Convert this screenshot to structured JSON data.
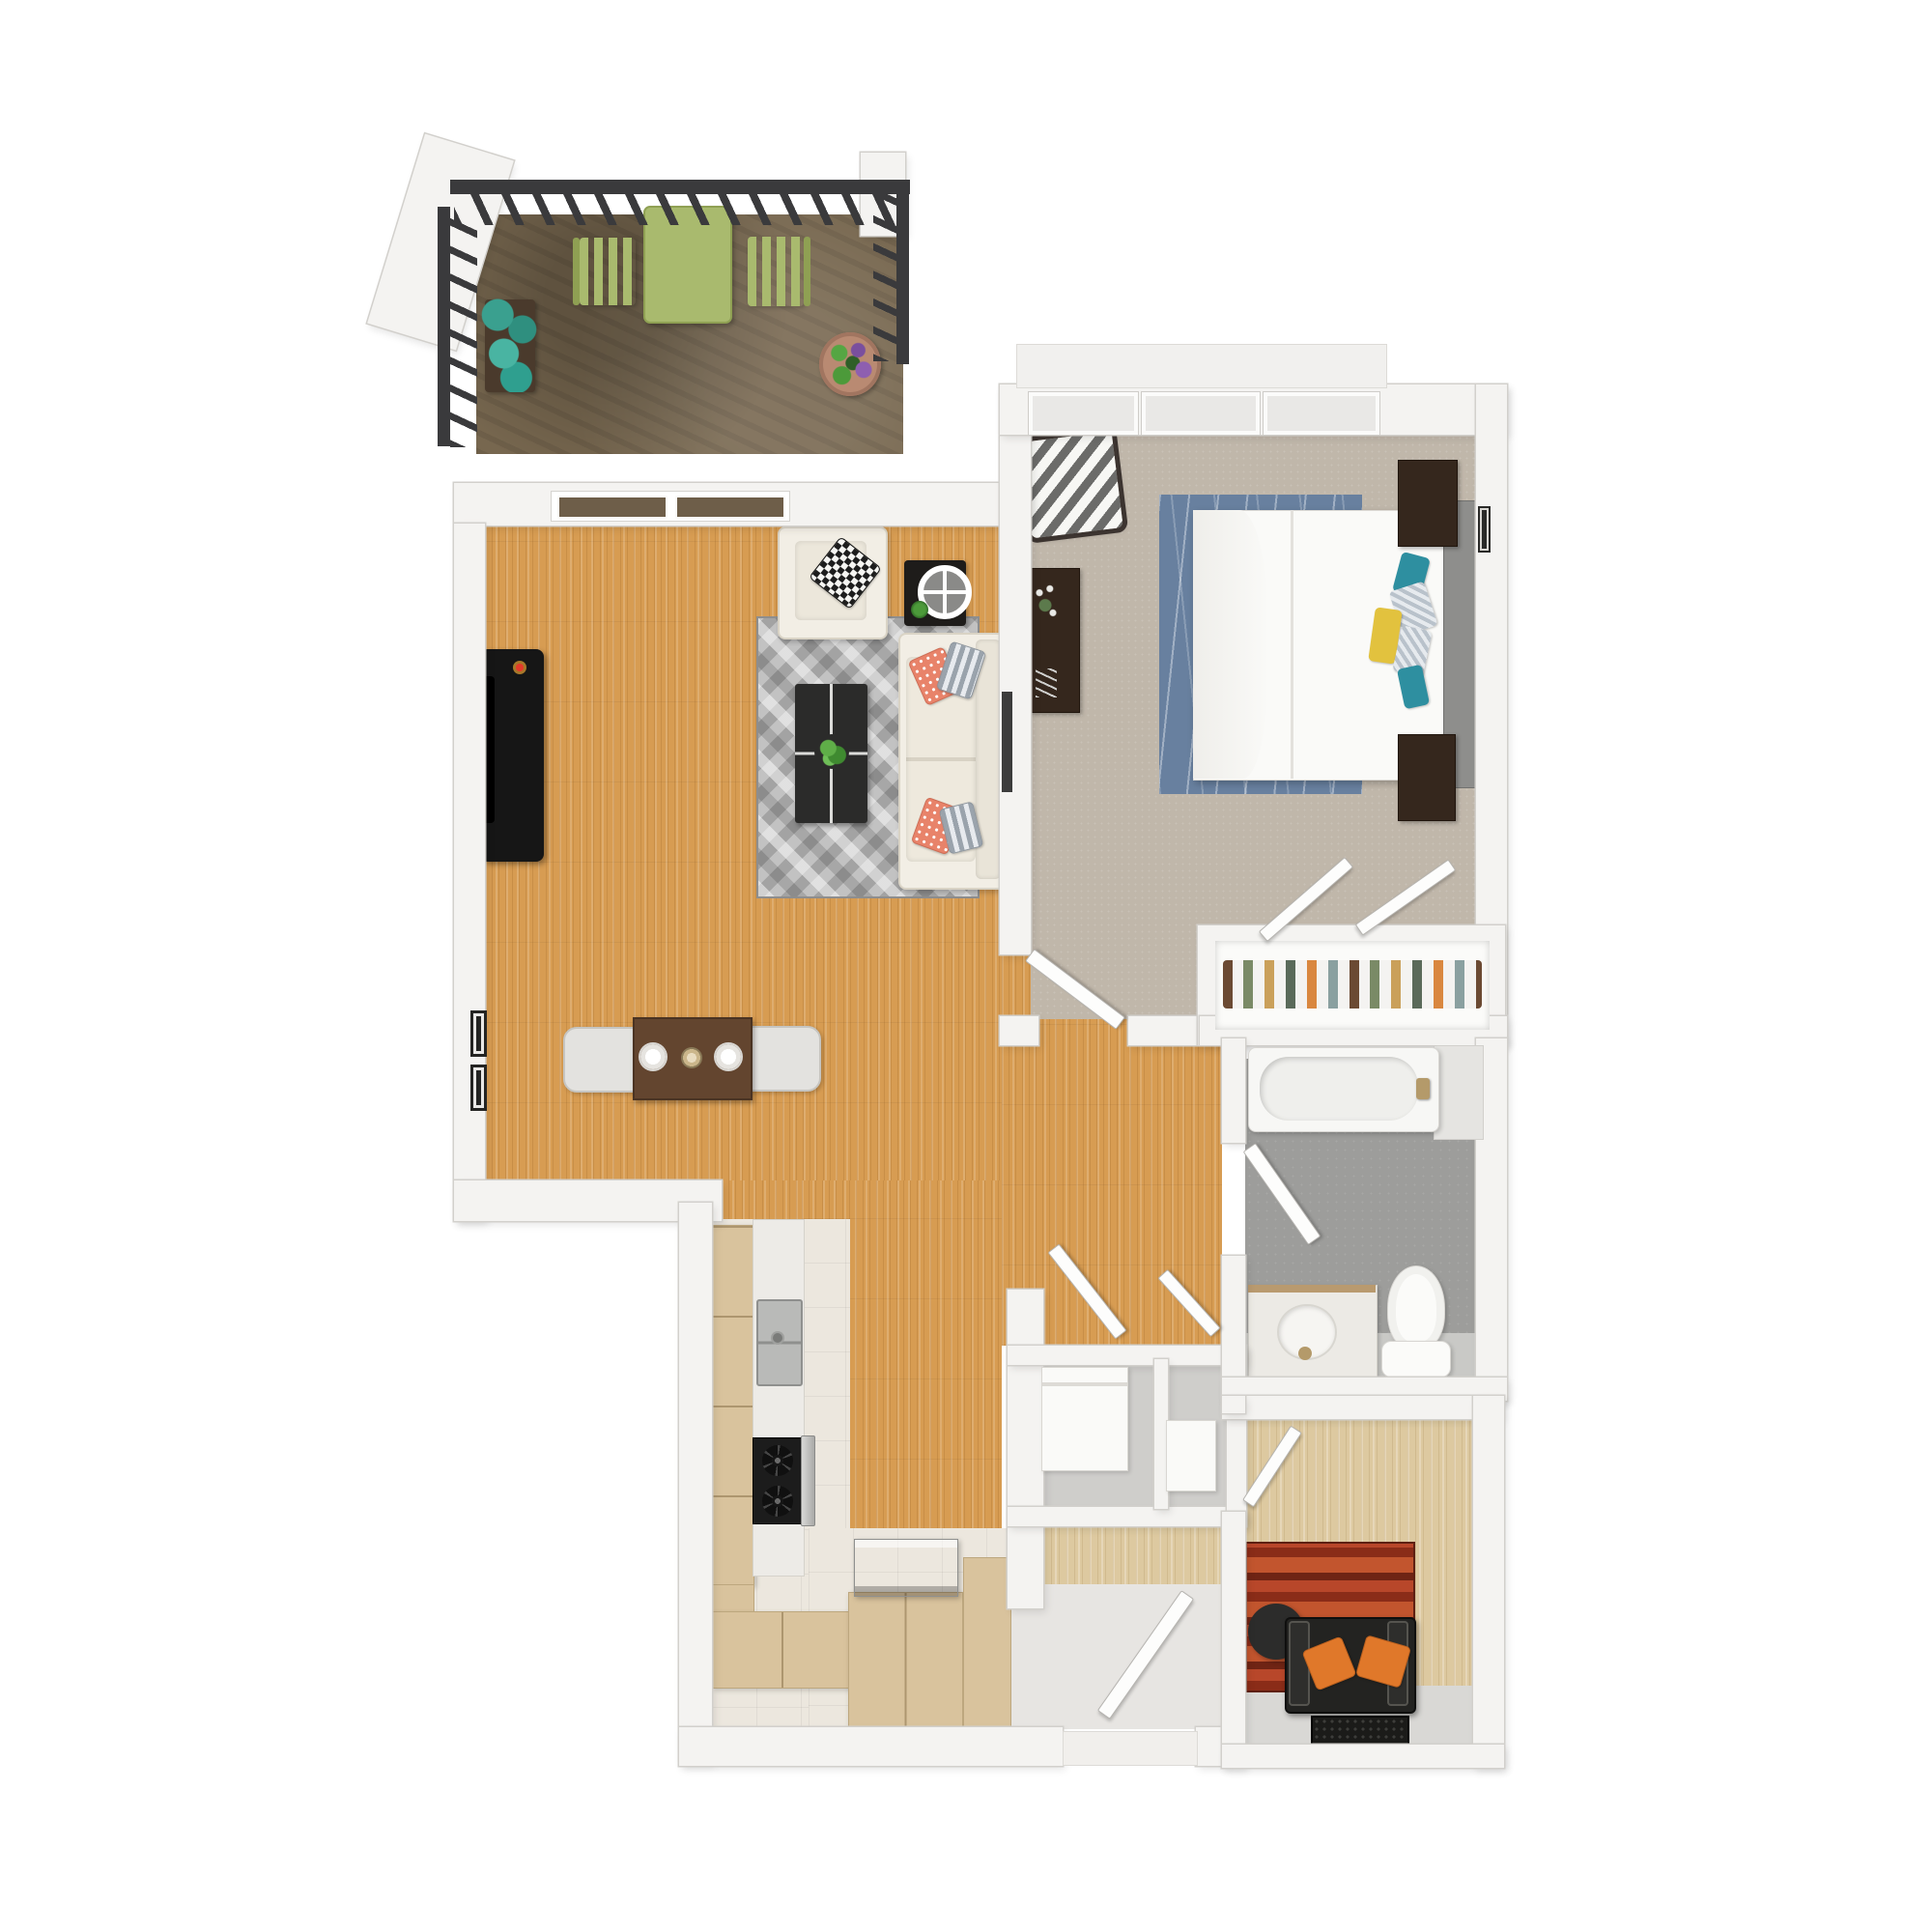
{
  "meta": {
    "description": "3D top-down rendered floor plan of a one-bedroom, one-bathroom apartment with balcony and den",
    "style": "photoreal dollhouse top view, white background, no text labels"
  },
  "palette": {
    "background": "#ffffff",
    "wall": "#f4f3f1",
    "wood_floor": "#d79c52",
    "light_wood_floor": "#ddc9a0",
    "bedroom_carpet": "#c0b7aa",
    "balcony_floor": "#77674f",
    "bathroom_floor": "#9d9d9b",
    "entry_tile": "#e7e5e2",
    "railing": "#3a3a3c",
    "patio_furniture_green": "#a9ba6e",
    "cabinet_tan": "#d9c39d",
    "countertop": "#edebe7",
    "stainless": "#c2c3c1",
    "gray_rug": "#a3a3a3",
    "blue_rug": "#68809f",
    "red_rug": "#a93a22",
    "sofa_white": "#f2eee5",
    "accent_coral": "#e8836a",
    "accent_teal": "#2e8fa0",
    "accent_yellow": "#e2c23e",
    "accent_orange": "#e0782a"
  },
  "rooms": {
    "balcony": {
      "label": "Balcony with slatted railing, green bistro table and two chairs, planter box and potted flowers"
    },
    "living": {
      "label": "Living room with sliding glass door, TV console, white armchair, side table with clock, gray geometric rug, black coffee table and white sofa"
    },
    "dining": {
      "label": "Dining nook with wood table, two place settings and two chairs, two framed pictures on wall"
    },
    "kitchen": {
      "label": "Galley kitchen with tan cabinets, sink counter, gas range with oven, base cabinets and island with appliance"
    },
    "bedroom": {
      "label": "Bedroom with three windows, chevron accent chair, desk, queen bed with pillows, two nightstands with lamps and blue rug"
    },
    "closet": {
      "label": "Bedroom closet with open bifold doors and hanging clothes"
    },
    "bathroom": {
      "label": "Bathroom with bathtub, vanity sink, toilet and inward-swinging door"
    },
    "utility": {
      "label": "Utility closet with washer and storage cabinet behind double doors"
    },
    "den": {
      "label": "Den with red striped rug, round table, black armchair with orange pillows and doormat"
    },
    "entry": {
      "label": "Entry with tiled floor and front door"
    }
  },
  "furniture_icons": [
    "balcony-table",
    "balcony-chair",
    "planter",
    "potted-plant",
    "sliding-glass-door",
    "tv-console",
    "armchair",
    "side-table-clock",
    "coffee-table",
    "sofa",
    "dining-table",
    "dining-chair",
    "picture-frame",
    "upper-cabinets",
    "kitchen-sink",
    "gas-range",
    "oven-door",
    "kitchen-island",
    "island-appliance",
    "window",
    "chevron-chair",
    "bedroom-desk",
    "bed",
    "headboard",
    "nightstand",
    "table-lamp",
    "closet-clothes",
    "bifold-door",
    "bathtub",
    "vanity-sink",
    "toilet",
    "washer",
    "storage-cabinet",
    "round-table",
    "den-armchair",
    "doormat",
    "interior-door"
  ]
}
